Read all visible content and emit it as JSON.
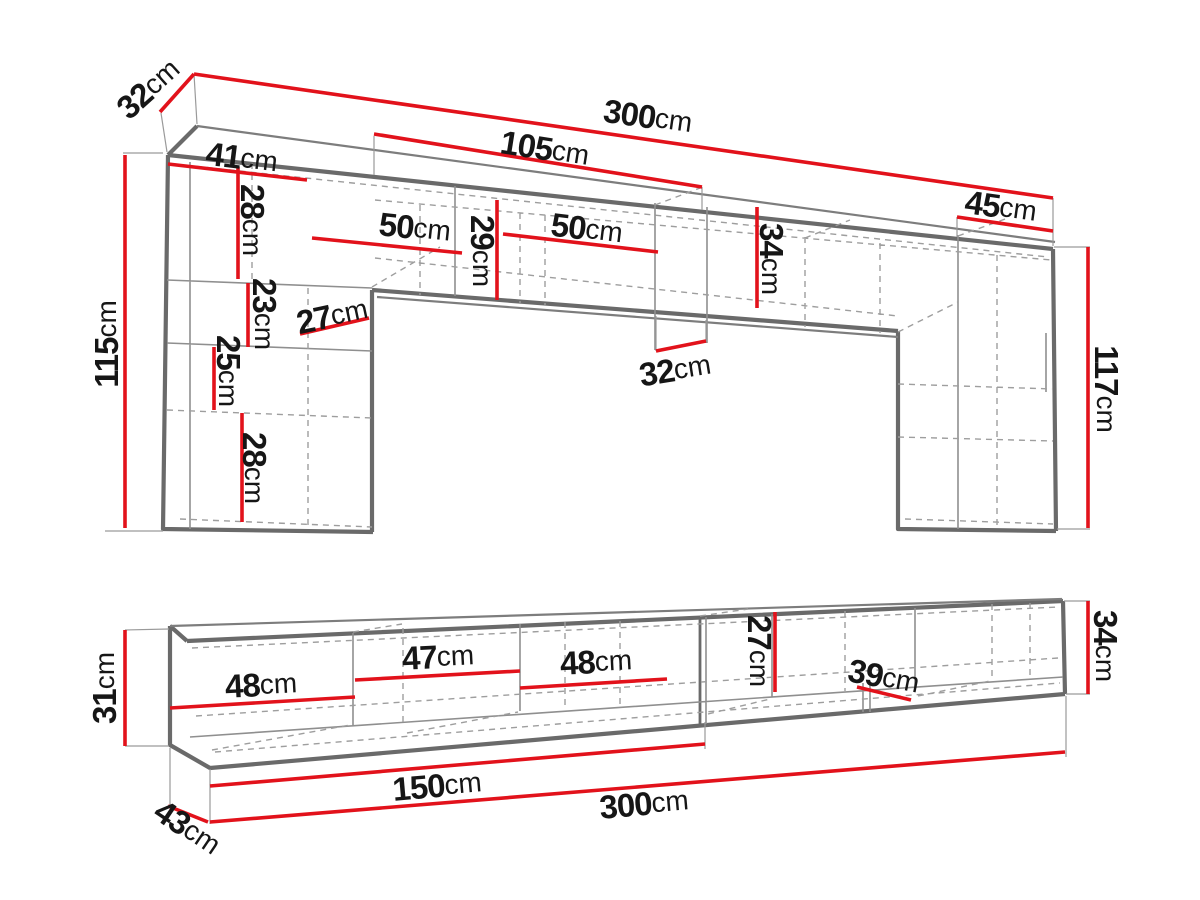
{
  "colors": {
    "red": "#e2121b",
    "outline": "#6a6a6a",
    "thin": "#8f8f8f",
    "dash": "#9e9e9e",
    "label": "#161616",
    "background": "#ffffff"
  },
  "wall_unit": {
    "dims": {
      "top_depth": {
        "value": "32",
        "unit": "cm"
      },
      "total_width": {
        "value": "300",
        "unit": "cm"
      },
      "bridge_span": {
        "value": "105",
        "unit": "cm"
      },
      "right_cabinet_width": {
        "value": "45",
        "unit": "cm"
      },
      "left_cabinet_width": {
        "value": "41",
        "unit": "cm"
      },
      "left_section1_height": {
        "value": "28",
        "unit": "cm"
      },
      "left_cubby_width": {
        "value": "50",
        "unit": "cm"
      },
      "bridge_inner_height": {
        "value": "29",
        "unit": "cm"
      },
      "mid_cubby_width": {
        "value": "50",
        "unit": "cm"
      },
      "bridge_front_height": {
        "value": "34",
        "unit": "cm"
      },
      "left_section2_height": {
        "value": "23",
        "unit": "cm"
      },
      "left_niche_width": {
        "value": "27",
        "unit": "cm"
      },
      "left_section3_height": {
        "value": "25",
        "unit": "cm"
      },
      "bridge_depth": {
        "value": "32",
        "unit": "cm"
      },
      "left_section4_height": {
        "value": "28",
        "unit": "cm"
      },
      "left_height": {
        "value": "115",
        "unit": "cm"
      },
      "right_height": {
        "value": "117",
        "unit": "cm"
      }
    }
  },
  "tv_stand": {
    "dims": {
      "left_height": {
        "value": "31",
        "unit": "cm"
      },
      "cubby1_width": {
        "value": "48",
        "unit": "cm"
      },
      "cubby2_width": {
        "value": "47",
        "unit": "cm"
      },
      "cubby3_width": {
        "value": "48",
        "unit": "cm"
      },
      "inner_height": {
        "value": "27",
        "unit": "cm"
      },
      "cubby4_width": {
        "value": "39",
        "unit": "cm"
      },
      "right_height": {
        "value": "34",
        "unit": "cm"
      },
      "half_width": {
        "value": "150",
        "unit": "cm"
      },
      "total_width": {
        "value": "300",
        "unit": "cm"
      },
      "depth": {
        "value": "43",
        "unit": "cm"
      }
    }
  }
}
